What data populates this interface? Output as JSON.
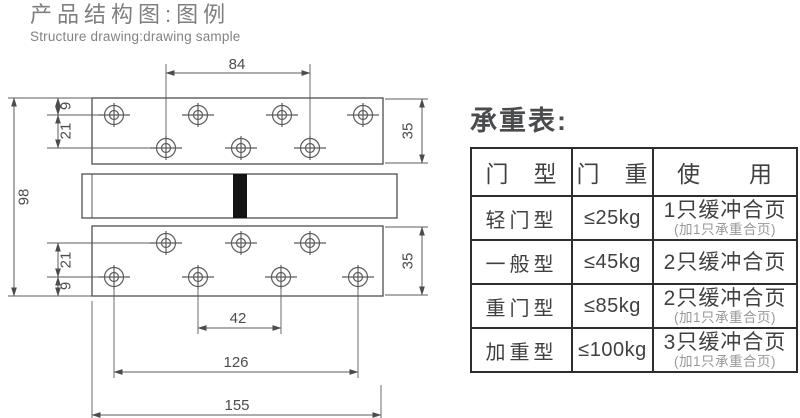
{
  "page_title": {
    "zh": "产品结构图:图例",
    "en": "Structure drawing:drawing sample"
  },
  "drawing": {
    "dimensions": {
      "top_hole_span": "84",
      "top_edge_to_row1": "9",
      "top_row1_to_row2": "21",
      "total_height": "98",
      "top_plate_height": "35",
      "bottom_plate_height": "35",
      "bottom_row1_to_row2": "21",
      "bottom_row2_to_edge": "9",
      "bottom_inner_span": "42",
      "bottom_outer_span": "126",
      "plate_width": "155"
    }
  },
  "load_table": {
    "title": "承重表:",
    "headers": {
      "door_type": "门　型",
      "door_weight": "门　重",
      "usage": "使　　用"
    },
    "rows": [
      {
        "type": "轻门型",
        "weight": "≤25kg",
        "use": "1只缓冲合页",
        "note": "(加1只承重合页)"
      },
      {
        "type": "一般型",
        "weight": "≤45kg",
        "use": "2只缓冲合页",
        "note": ""
      },
      {
        "type": "重门型",
        "weight": "≤85kg",
        "use": "2只缓冲合页",
        "note": "(加1只承重合页)"
      },
      {
        "type": "加重型",
        "weight": "≤100kg",
        "use": "3只缓冲合页",
        "note": "(加1只承重合页)"
      }
    ]
  },
  "colors": {
    "line": "#5a5b5d",
    "dim_text": "#4b4c4e",
    "title_text": "#7e7f81",
    "table_border": "#2c2d2f",
    "table_text": "#3f4042",
    "note_text": "#96989a",
    "barrel_pin": "#141414"
  }
}
